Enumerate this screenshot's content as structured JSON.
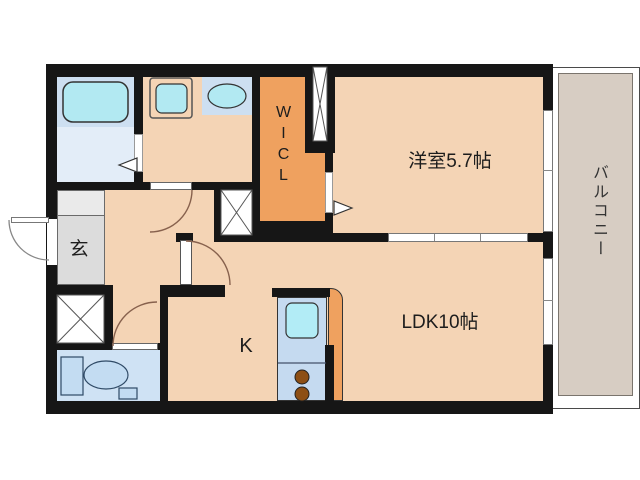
{
  "plan": {
    "type": "apartment-floorplan",
    "rooms": {
      "bedroom": {
        "label": "洋室5.7帖",
        "area_jo": "5.7"
      },
      "ldk": {
        "label": "LDK10帖",
        "area_jo": "10"
      },
      "kitchen": {
        "label": "K"
      },
      "wicl": {
        "label": "WICL"
      },
      "genkan": {
        "label": "玄"
      },
      "balcony": {
        "label": "バルコニー"
      }
    },
    "fixtures": [
      "bathtub",
      "washing-machine-pan",
      "washbasin",
      "toilet",
      "kitchen-sink",
      "gas-stove-two-burners"
    ],
    "colors": {
      "wall": "#161616",
      "floor_main": "#f4d4b5",
      "wicl_orange": "#efa15f",
      "counter_orange": "#efa15f",
      "bath_zone": "#cddff1",
      "bath_floor": "#e3edf8",
      "water_cyan": "#b2e9f2",
      "toilet_floor": "#cfe2f4",
      "kitchen_counter": "#c5daf0",
      "burner_brown": "#8d4f15",
      "genkan_gray": "#dcdcdc",
      "balcony_beige": "#d7cdc3"
    }
  }
}
